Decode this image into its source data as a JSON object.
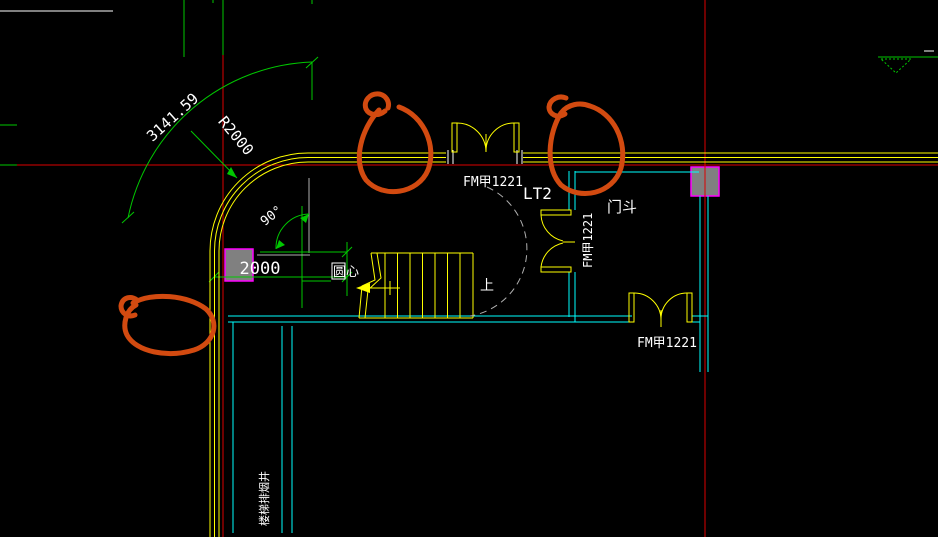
{
  "view": {
    "type": "cad-floor-plan",
    "background": "#000000"
  },
  "palette": {
    "exterior_wall": "#ffff00",
    "partition_wall": "#00ffff",
    "dimension_lines": "#00c800",
    "axis_grid": "#dd0000",
    "text": "#ffffff",
    "column_fill": "#808080",
    "column_border": "#ff00ff",
    "markup_annotation": "#d24a10",
    "walking_line": "#b0b0b0"
  },
  "dimensions": {
    "arc_length": "3141.59",
    "radius": "R2000",
    "angle": "90°",
    "offset": "2000"
  },
  "labels": {
    "door_top": "FM甲1221",
    "door_side": "FM甲1221",
    "door_bottom": "FM甲1221",
    "stair_id": "LT2",
    "vestibule": "门斗",
    "circle_center": "圆心",
    "up": "上",
    "shaft": "楼梯排烟井"
  }
}
